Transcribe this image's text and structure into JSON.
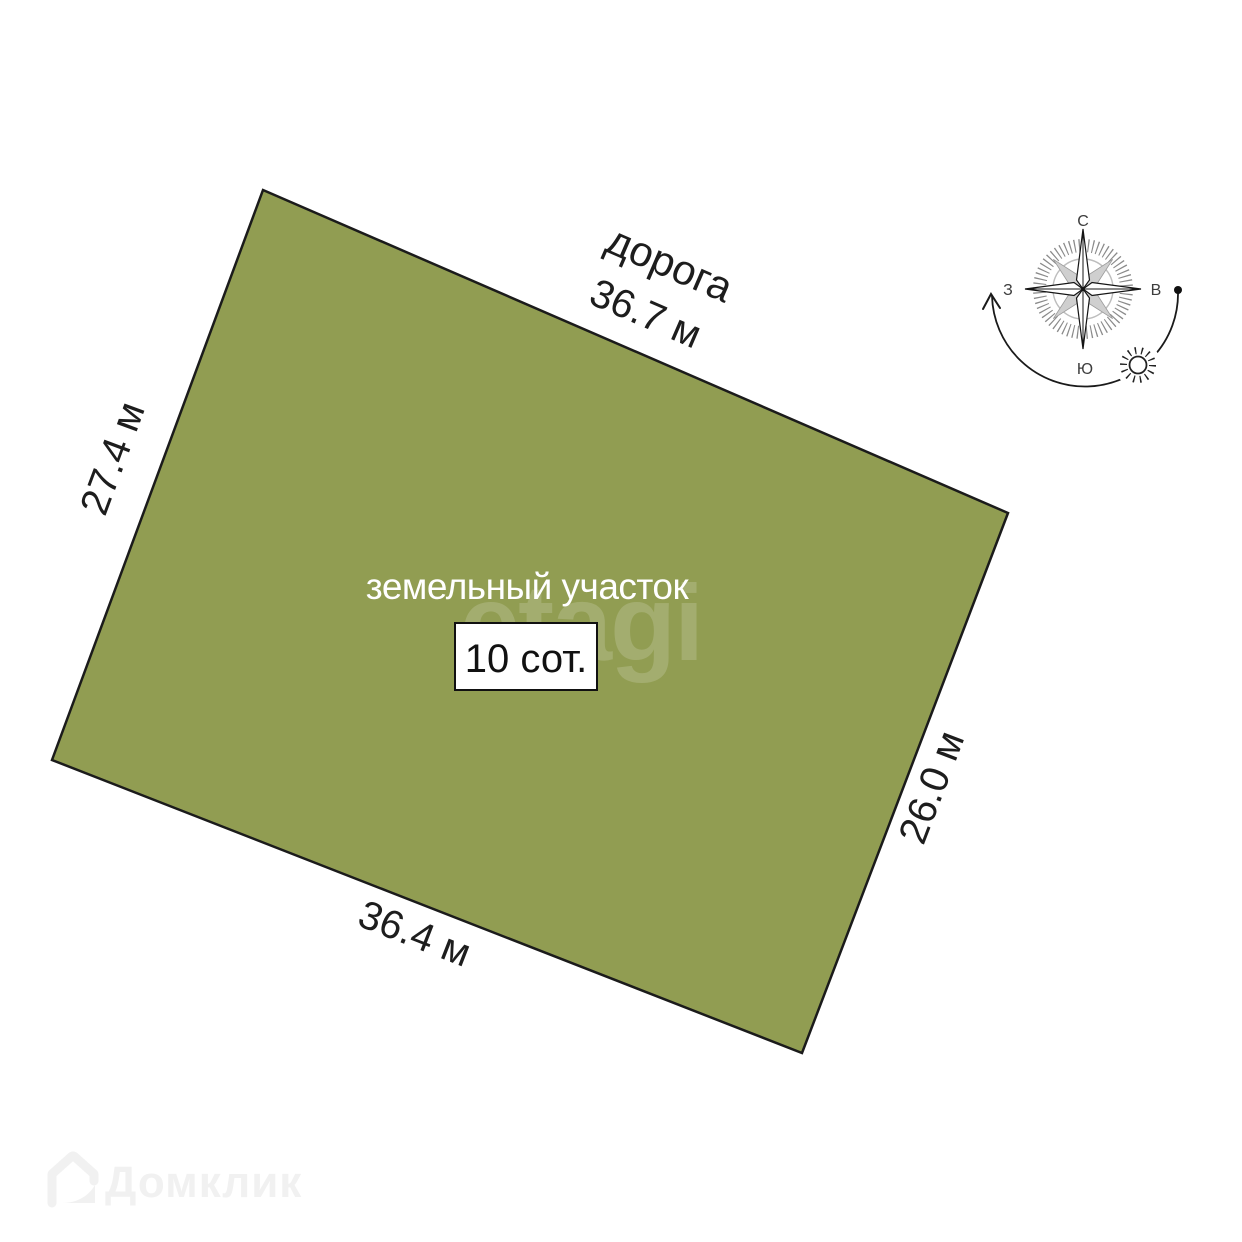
{
  "plot": {
    "fill_color": "#919d52",
    "label": "земельный участок",
    "area": "10 сот.",
    "road_label": "дорога",
    "top_length": "36.7 м",
    "left_length": "27.4 м",
    "right_length": "26.0 м",
    "bottom_length": "36.4 м"
  },
  "compass": {
    "north": "С",
    "south": "Ю",
    "west": "З",
    "east": "В"
  },
  "watermarks": {
    "center": "etagi",
    "bottom_left": "Домклик"
  }
}
